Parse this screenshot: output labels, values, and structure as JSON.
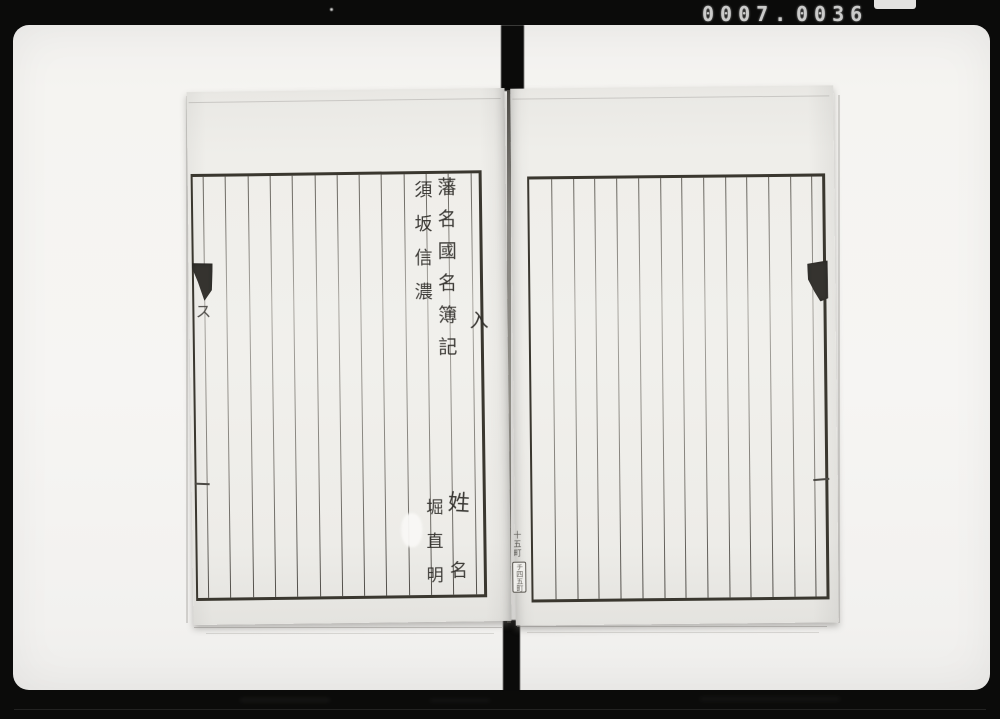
{
  "counter": {
    "left": "0007.",
    "right": "0036"
  },
  "left_page": {
    "title_column": "藩名國名簿記",
    "domain_province": "須坂信濃",
    "received_mark": "入",
    "edge_mark": "ス",
    "surname_label": "姓",
    "name_label": "名",
    "person_name": "堀直明",
    "ruled_columns": 14
  },
  "right_page": {
    "spine_note": "十五町",
    "spine_label": "チ四五町",
    "ruled_columns": 14
  },
  "colors": {
    "film_black": "#0b0b0a",
    "backdrop_white": "#f5f4f1",
    "paper": "#efeeea",
    "rule_line": "#5f5b54",
    "ink": "#2e2c28",
    "counter_text": "#cbcbca"
  }
}
